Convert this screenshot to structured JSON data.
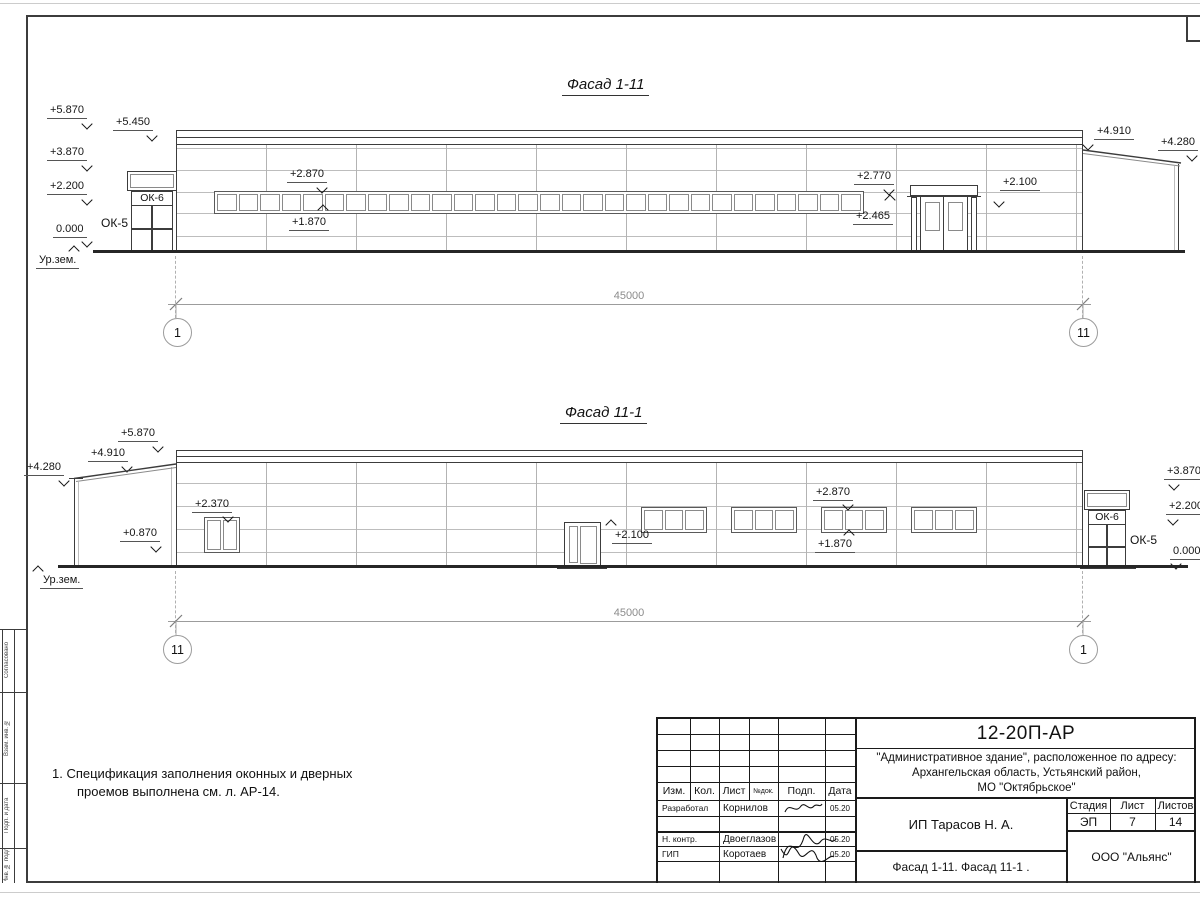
{
  "facade1": {
    "title": "Фасад 1-11",
    "marks": {
      "p5870": "+5.870",
      "p5450": "+5.450",
      "p3870": "+3.870",
      "p2200": "+2.200",
      "z0": "0.000",
      "ground": "Ур.зем.",
      "ok6": "ОК-6",
      "ok5": "ОК-5",
      "band_top": "+2.870",
      "band_bot": "+1.870",
      "door_top": "+2.770",
      "canopy": "+2.465",
      "wall": "+2.100",
      "annex_high": "+4.910",
      "annex_low": "+4.280"
    },
    "dim": {
      "value": "45000",
      "axis_left": "1",
      "axis_right": "11"
    }
  },
  "facade2": {
    "title": "Фасад 11-1",
    "marks": {
      "p5870": "+5.870",
      "p4910": "+4.910",
      "p4280": "+4.280",
      "p2370": "+2.370",
      "p0870": "+0.870",
      "door": "+2.100",
      "band_top": "+2.870",
      "band_bot": "+1.870",
      "ok6": "ОК-6",
      "ok5": "ОК-5",
      "ground": "Ур.зем.",
      "r3870": "+3.870",
      "r2200": "+2.200",
      "r0": "0.000"
    },
    "dim": {
      "value": "45000",
      "axis_left": "11",
      "axis_right": "1"
    }
  },
  "note": {
    "line1": "1. Спецификация заполнения оконных и дверных",
    "line2": "проемов выполнена см. л. АР-14."
  },
  "titleblock": {
    "doc_code": "12-20П-АР",
    "address1": "\"Административное здание\", расположенное по адресу:",
    "address2": "Архангельская область, Устьянский район,",
    "address3": "МО \"Октябрьское\"",
    "headers": {
      "izm": "Изм.",
      "kol": "Кол.",
      "list": "Лист",
      "ndok": "№док.",
      "podp": "Подп.",
      "data": "Дата",
      "stage": "Стадия",
      "sheet": "Лист",
      "sheets": "Листов"
    },
    "rows": [
      {
        "role": "Разработал",
        "name": "Корнилов",
        "date": "05.20"
      },
      {
        "role": "Н. контр.",
        "name": "Двоеглазов",
        "date": "05.20"
      },
      {
        "role": "ГИП",
        "name": "Коротаев",
        "date": "05.20"
      }
    ],
    "stage": "ЭП",
    "sheet_no": "7",
    "sheets_total": "14",
    "client": "ИП Тарасов Н. А.",
    "doc_title": "Фасад 1-11. Фасад 11-1 .",
    "org": "ООО \"Альянс\""
  },
  "side_stamp": {
    "c1": "Согласовано",
    "c2": "Взам. инв. №",
    "c3": "Подп. и дата",
    "c4": "Инв. № подл."
  }
}
